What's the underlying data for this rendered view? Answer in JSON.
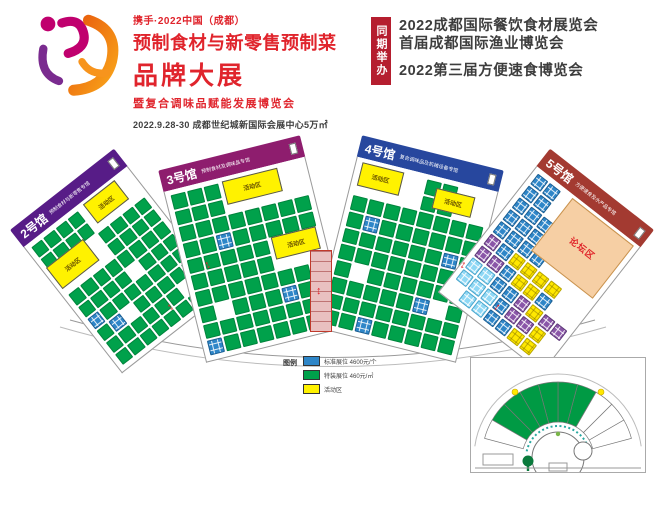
{
  "header": {
    "logo": {
      "tagline": "携手·2022中国（成都）",
      "title_line1": "预制食材与新零售预制菜",
      "title_line2": "品牌大展",
      "subtitle": "暨复合调味品赋能发展博览会",
      "date_venue": "2022.9.28-30  成都世纪城新国际会展中心5万㎡",
      "mark_colors": {
        "magenta": "#c0006e",
        "purple": "#7a2b8f",
        "orange1": "#e85a0c",
        "orange2": "#f9a51a"
      }
    },
    "concurrent": {
      "badge": "同期举办",
      "badge_color": "#b51e2f",
      "events": [
        "2022成都国际餐饮食材展览会",
        "首届成都国际渔业博览会",
        "2022第三届方便速食博览会"
      ]
    }
  },
  "floorplan": {
    "booth_colors": {
      "G": "#00a14b",
      "B": "#2e86c8",
      "C": "#8fd8f5",
      "Y": "#ffe800",
      "P": "#8a56a8"
    },
    "halls": [
      {
        "id": "2",
        "name": "2号馆",
        "subtitle": "预制食材与新零售专馆",
        "band_color": "#571c87",
        "x": 52,
        "y": 50,
        "w": 132,
        "h": 182,
        "rot": -38,
        "cols": 8,
        "grid": [
          "GGGG....",
          "GGGG....",
          "....GGGG",
          "....GGGG",
          "GGGGGGGG",
          "GGGG.GGG",
          "BGGGGGGG",
          "GB.GGGGG",
          "GGGGGG.G",
          "GGGGGGGG"
        ],
        "features": [
          {
            "label": "活动区",
            "type": "activity",
            "x": 3,
            "y": 19,
            "w": 36,
            "h": 17
          },
          {
            "label": "活动区",
            "type": "activity",
            "x": 55,
            "y": 2,
            "w": 31,
            "h": 15
          }
        ]
      },
      {
        "id": "3",
        "name": "3号馆",
        "subtitle": "预制食材及调味品专馆",
        "band_color": "#8e1d6e",
        "x": 180,
        "y": 30,
        "w": 146,
        "h": 198,
        "rot": -14,
        "cols": 8,
        "grid": [
          "GGG.....",
          "GGG.....",
          "GGGGGGGG",
          "GGBGGGGG",
          "GGGGG...",
          "GGGGG...",
          "GGGGGGGG",
          "G.GGGBGG",
          "GGGGGGGG",
          "BGGGGGGG"
        ],
        "features": [
          {
            "label": "活动区",
            "type": "activity",
            "x": 40,
            "y": 2,
            "w": 40,
            "h": 14
          },
          {
            "label": "活动区",
            "type": "activity",
            "x": 64,
            "y": 40,
            "w": 32,
            "h": 13
          }
        ]
      },
      {
        "id": "4",
        "name": "4号馆",
        "subtitle": "复合调味品及机械设备专馆",
        "band_color": "#27479e",
        "x": 336,
        "y": 30,
        "w": 146,
        "h": 198,
        "rot": 14,
        "cols": 8,
        "grid": [
          "....GG..",
          "....GG..",
          "GGGGGGGG",
          "GBGGGGGG",
          "GGGGGGBG",
          "GGGGGGGG",
          "G.GGGGGG",
          "GGGGGB.G",
          "GGGGGGGG",
          "GGBGGGGG"
        ],
        "features": [
          {
            "label": "活动区",
            "type": "activity",
            "x": 4,
            "y": 2,
            "w": 30,
            "h": 14
          },
          {
            "label": "活动区",
            "type": "activity",
            "x": 58,
            "y": 6,
            "w": 28,
            "h": 12
          }
        ]
      },
      {
        "id": "5",
        "name": "5号馆",
        "subtitle": "方便速食及水产品专馆",
        "band_color": "#a33a31",
        "x": 480,
        "y": 50,
        "w": 132,
        "h": 182,
        "rot": 38,
        "cols": 8,
        "grid": [
          "BB......",
          "BB......",
          "BBB.....",
          "BBB.....",
          "BBBB....",
          "PBYYYY..",
          "PPBYYB..",
          "CCBBPYPP",
          "CCCBPPY.",
          ".CCBBYY."
        ],
        "features": [
          {
            "label": "论坛区",
            "type": "forum",
            "x": 36,
            "y": 2,
            "w": 60,
            "h": 42
          }
        ]
      }
    ],
    "spine": {
      "x": 310,
      "y": 130,
      "w": 20,
      "h": 80
    },
    "corridor_arrows": [
      {
        "x": 205,
        "y": 140,
        "rot": -25
      },
      {
        "x": 316,
        "y": 166,
        "rot": 0
      },
      {
        "x": 460,
        "y": 140,
        "rot": 25
      },
      {
        "x": 168,
        "y": 182,
        "rot": -40
      },
      {
        "x": 494,
        "y": 182,
        "rot": 40
      }
    ],
    "arrow_glyph": "↕",
    "legend": {
      "title": "图例",
      "items": [
        {
          "color": "#2e86c8",
          "label": "标准展位 4600元/个"
        },
        {
          "color": "#00a14b",
          "label": "特装展位 460元/㎡"
        },
        {
          "color": "#fff200",
          "label": "活动区"
        }
      ]
    },
    "minimap": {
      "green": "#009a44",
      "center_x": 87,
      "center_y": 100,
      "r_inner": 36,
      "r_outer": 76,
      "seg_start": 15,
      "seg_end": 165,
      "seg_step": 15,
      "green_starts": [
        60,
        75,
        90,
        105,
        120,
        135
      ]
    }
  }
}
